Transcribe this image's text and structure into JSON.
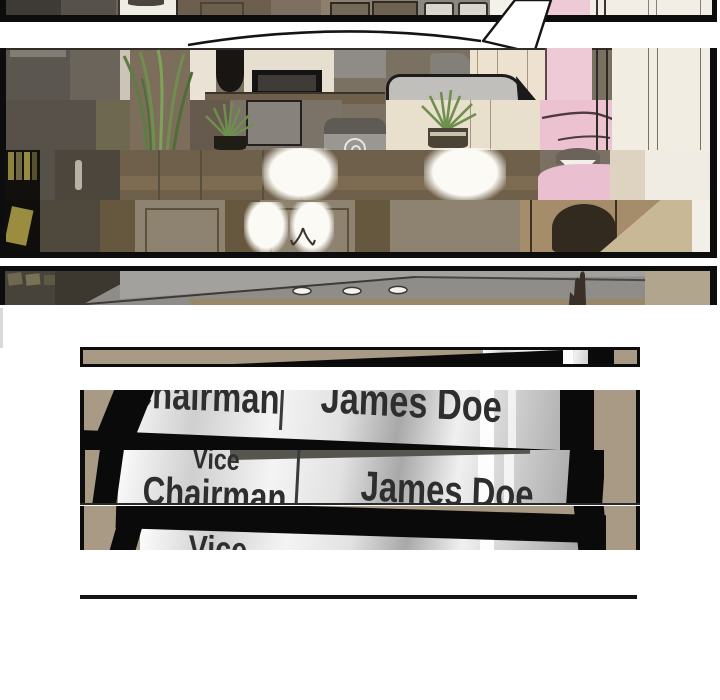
{
  "comic": {
    "medium": "webtoon comic page, partially loaded with glitched horizontal slices",
    "office_panel": {
      "chair_brand": "NORU"
    },
    "nameplate_panel": {
      "title_word1": "Vice",
      "title_word2": "Chairman",
      "person_name": "James Doe"
    }
  },
  "colors": {
    "page_background": "#ffffff",
    "panel_border": "#0d0d0d",
    "wood_brown": "#6f604b",
    "tan_wall": "#a89a85",
    "plate_silver": "#e6e6e6",
    "plate_text": "#2e2e2e",
    "pink_clothing": "#eec9d6",
    "plant_green": "#6f8f4e",
    "ceiling_gray": "#8f8d89",
    "glow_white": "#faf8f2",
    "left_artifact_gray": "#d9d9d9"
  }
}
